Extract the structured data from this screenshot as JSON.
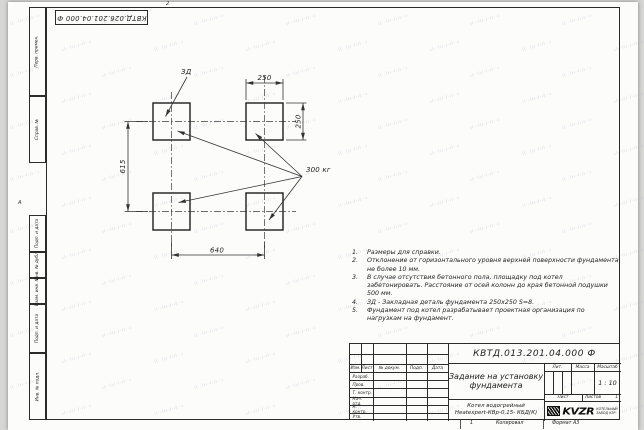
{
  "sheet": {
    "top_designation": "КВТД.026.201.04.000 Ф",
    "zone_top": "2",
    "zone_left": "А",
    "zone_bottom": "1",
    "copied_label": "Копировал",
    "format_label": "Формат А3"
  },
  "margin_boxes": [
    "Перв. примен.",
    "Справ. №",
    "Подп. и дата",
    "Инв. № дубл.",
    "Взам. инв. №",
    "Подп. и дата",
    "Инв. № подл."
  ],
  "drawing": {
    "dim_top_width": "250",
    "dim_right_height": "250",
    "dim_left_span": "615",
    "dim_bottom_span": "640",
    "plate_label": "ЗД",
    "load_label": "300 кг"
  },
  "notes": [
    {
      "num": "1.",
      "text": "Размеры для справки."
    },
    {
      "num": "2.",
      "text": "Отклонение от горизонтального уровня верхней поверхности фундамента не более 10 мм."
    },
    {
      "num": "3.",
      "text": "В случае отсутствия бетонного пола, площадку под котел забетонировать. Расстояние от осей колонн до края бетонной подушки 500 мм."
    },
    {
      "num": "4.",
      "text": "ЗД - Закладная деталь фундамента 250х250 S=8."
    },
    {
      "num": "5.",
      "text": "Фундамент под котел разрабатывает проектная организация по нагрузкам на фундамент."
    }
  ],
  "titleblock": {
    "designation": "КВТД.013.201.04.000 Ф",
    "doc_title_line1": "Задание на установку",
    "doc_title_line2": "фундамента",
    "product_line1": "Котел водогрейный",
    "product_line2": "Heatexpert-КВр-0,15- КБД(К)",
    "header_cols": [
      "Изм.",
      "Лист",
      "№ докум.",
      "Подп.",
      "Дата"
    ],
    "sign_rows": [
      "Разраб.",
      "Пров.",
      "Т. контр.",
      "Нач. отд.",
      "Н. контр.",
      "Утв."
    ],
    "lit_label": "Лит.",
    "mass_label": "Масса",
    "scale_label": "Масштаб",
    "scale_value": "1 : 10",
    "sheet_label": "Лист",
    "sheets_label": "Листов",
    "sheets_value": "1",
    "company": {
      "logo_text": "KVZR",
      "tagline_line1": "КОТЕЛЬНЫЙ",
      "tagline_line2": "ЗАВОД КЗР"
    }
  },
  "watermark": {
    "tile": "ıl··lıı·l·ıl··ı"
  }
}
